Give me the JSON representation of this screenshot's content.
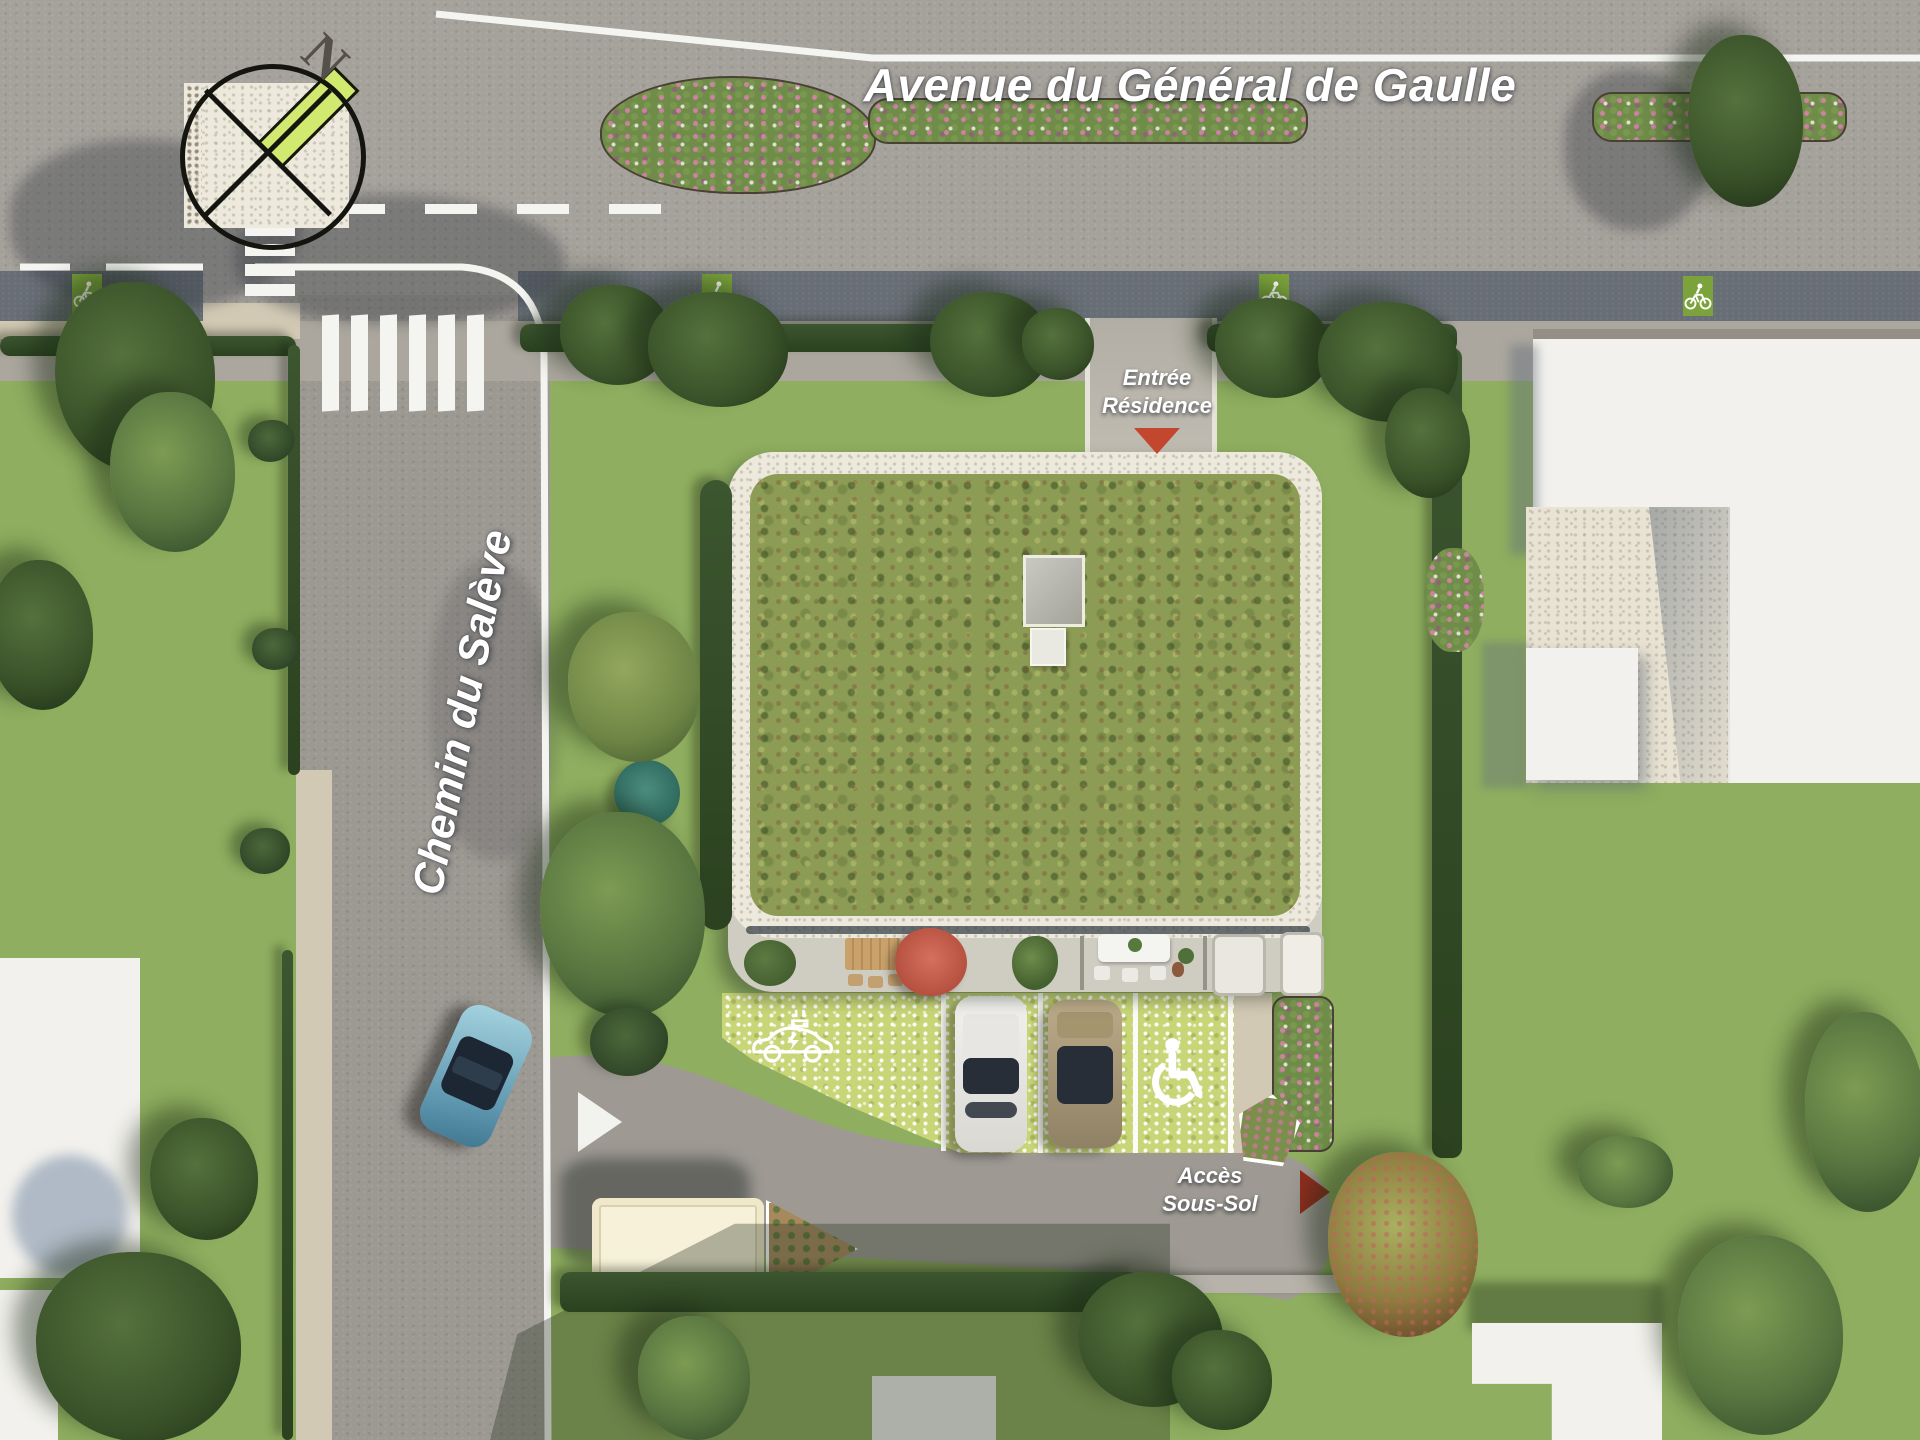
{
  "streets": {
    "avenue_label": "Avenue du Général de Gaulle",
    "side_street_label": "Chemin du Salève"
  },
  "markers": {
    "residence_entrance": {
      "line1": "Entrée",
      "line2": "Résidence"
    },
    "basement_access": {
      "line1": "Accès",
      "line2": "Sous-Sol"
    },
    "compass_north": "N"
  },
  "icons": {
    "bike_lane": "bicycle-icon",
    "accessible_parking": "wheelchair-icon",
    "ev_charging_bay": "ev-car-icon",
    "compass": "compass-rose-icon",
    "entrance_arrow": "triangle-down-arrow",
    "basement_arrow": "triangle-right-arrow",
    "yield_arrow": "triangle-right-arrow"
  },
  "colors": {
    "grass": "#8fae5f",
    "asphalt": "#a5a19b",
    "bike_lane_green": "#7ba23b",
    "green_roof": "#8d9c55",
    "paver_green": "#c9d678",
    "marker_arrow_red": "#b03524",
    "umbrella_terracotta": "#c4604f",
    "compass_bar_green": "#d2e96f"
  }
}
